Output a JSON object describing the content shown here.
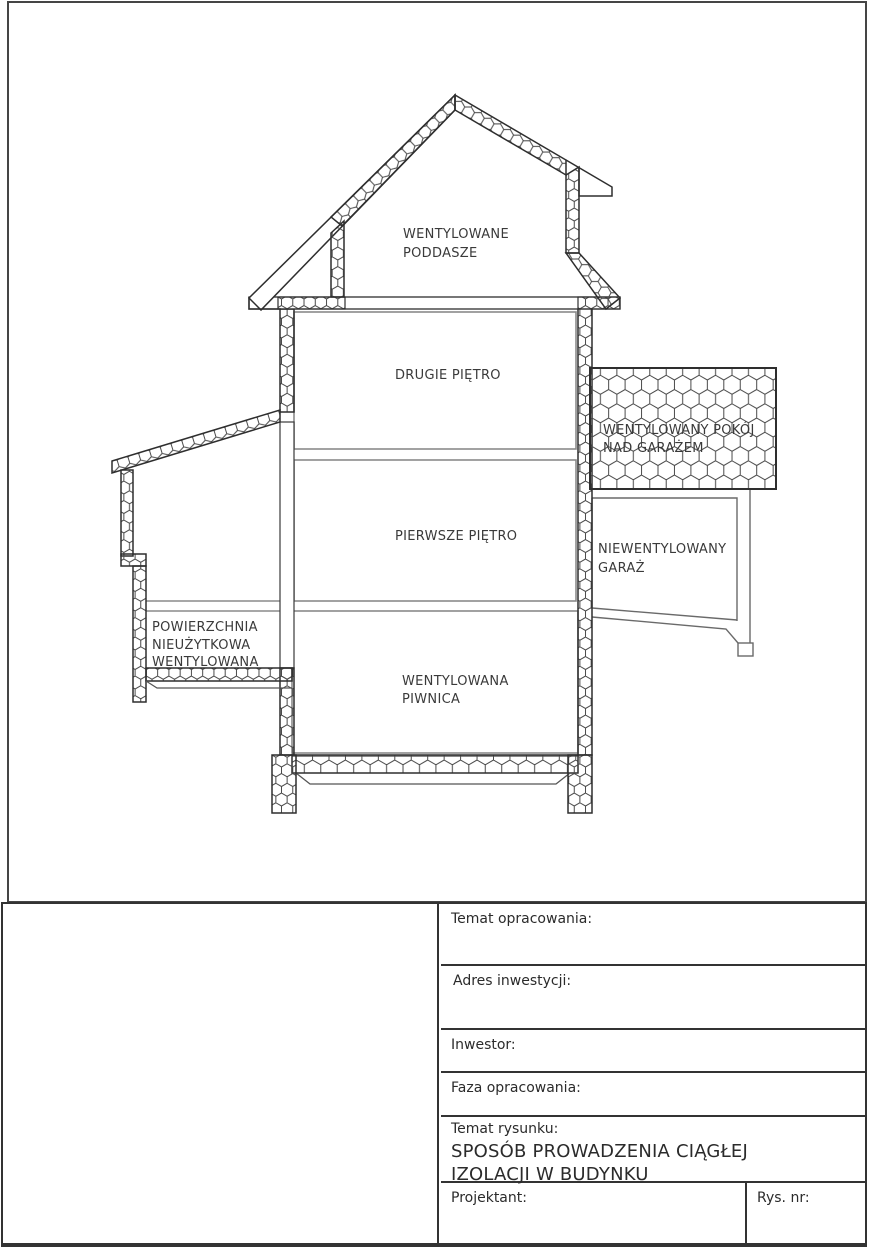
{
  "drawing": {
    "rooms": {
      "attic_line1": "WENTYLOWANE",
      "attic_line2": "PODDASZE",
      "second_floor": "DRUGIE PIĘTRO",
      "first_floor": "PIERWSZE PIĘTRO",
      "basement_line1": "WENTYLOWANA",
      "basement_line2": "PIWNICA",
      "room_over_garage_line1": "WENTYLOWANY POKÓJ",
      "room_over_garage_line2": "NAD GARAŻEM",
      "garage_line1": "NIEWENTYLOWANY",
      "garage_line2": "GARAŻ",
      "unused_area_line1": "POWIERZCHNIA",
      "unused_area_line2": "NIEUŻYTKOWA",
      "unused_area_line3": "WENTYLOWANA"
    }
  },
  "title_block": {
    "temat_opracowania": "Temat opracowania:",
    "adres_inwestycji": "Adres inwestycji:",
    "inwestor": "Inwestor:",
    "faza_opracowania": "Faza opracowania:",
    "temat_rysunku": "Temat rysunku:",
    "drawing_title_line1": "SPOSÓB PROWADZENIA CIĄGŁEJ",
    "drawing_title_line2": "IZOLACJI W BUDYNKU",
    "projektant": "Projektant:",
    "rys_nr": "Rys. nr:"
  },
  "colors": {
    "paper": "#ffffff",
    "ink": "#2f2f2f",
    "interior_line": "#8a8a8a",
    "label_text": "#3a3a3a",
    "frame": "#454545"
  }
}
